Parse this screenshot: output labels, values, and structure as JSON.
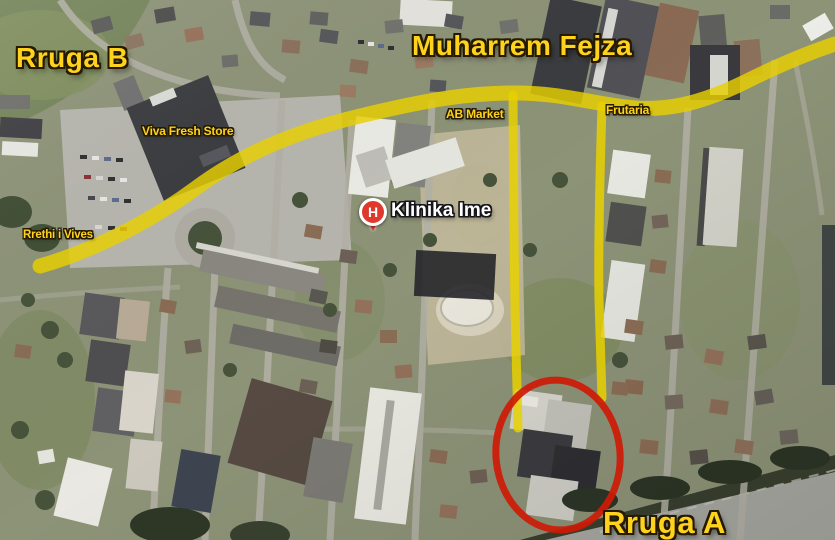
{
  "map": {
    "street_labels": {
      "rruga_b": "Rruga B",
      "muharrem_fejza": "Muharrem Fejza",
      "rruga_a": "Rruga A"
    },
    "poi_labels": {
      "viva_fresh_store": "Viva Fresh Store",
      "ab_market": "AB Market",
      "frutaria": "Frutaria",
      "rrethi_i_vives": "Rrethi i Vives"
    },
    "clinic_marker": {
      "label": "Klinika Ime",
      "icon_letter": "H"
    },
    "colors": {
      "route_highlight": "#E8D000",
      "label_yellow": "#FFD21E",
      "label_outline": "#241A00",
      "clinic_label_white": "#FFFFFF",
      "highlight_circle_red": "#CE1A07",
      "marker_red": "#E0382C"
    }
  }
}
